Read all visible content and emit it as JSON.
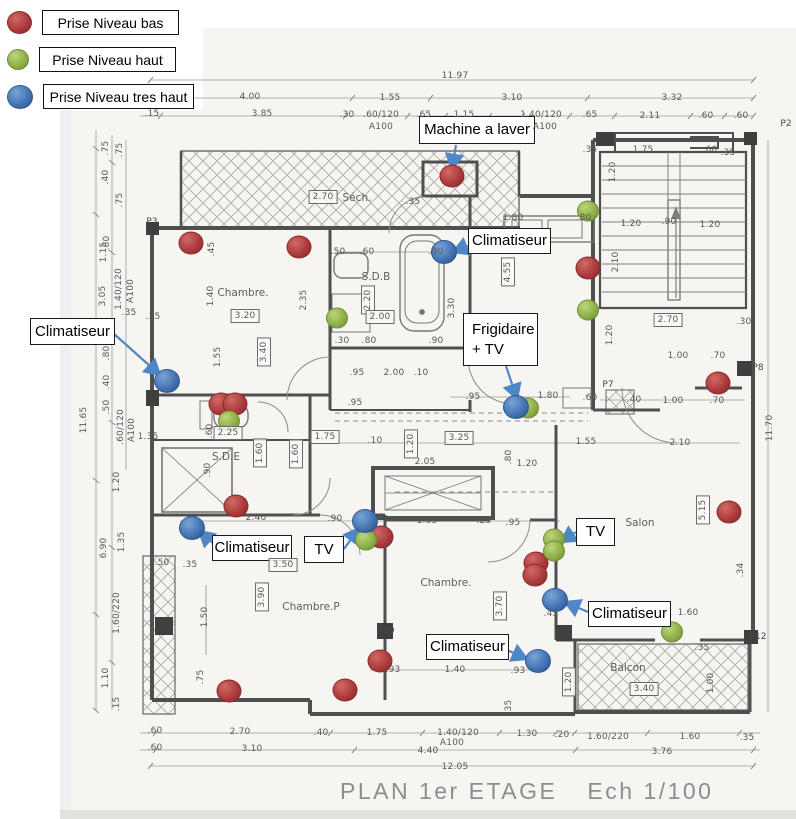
{
  "title": {
    "main": "PLAN 1er ETAGE",
    "scale": "Ech 1/100"
  },
  "colors": {
    "red": "#a93639",
    "green": "#8aac45",
    "blue": "#3e6fae",
    "arrow": "#4f86c6",
    "wall": "#4f4f4f"
  },
  "legend": {
    "items": [
      {
        "key": "low",
        "color": "red",
        "label": "Prise Niveau bas",
        "y": 10,
        "box_w": 137
      },
      {
        "key": "high",
        "color": "green",
        "label": "Prise Niveau haut",
        "y": 47,
        "box_w": 137
      },
      {
        "key": "very-high",
        "color": "blue",
        "label": "Prise Niveau tres haut",
        "y": 84,
        "box_w": 151
      }
    ]
  },
  "callouts": [
    {
      "id": "machine-a-laver",
      "lines": [
        "Machine a laver"
      ],
      "x": 419,
      "y": 116,
      "w": 116,
      "h": 28,
      "center": true,
      "arrow": {
        "from": [
          456,
          145
        ],
        "to": [
          452,
          169
        ]
      }
    },
    {
      "id": "climatiseur-top",
      "lines": [
        "Climatiseur"
      ],
      "x": 468,
      "y": 228,
      "w": 83,
      "h": 26,
      "center": true,
      "arrow": {
        "from": [
          468,
          246
        ],
        "to": [
          453,
          252
        ]
      }
    },
    {
      "id": "climatiseur-left",
      "lines": [
        "Climatiseur"
      ],
      "x": 30,
      "y": 318,
      "w": 85,
      "h": 27,
      "center": true,
      "arrow": {
        "from": [
          113,
          333
        ],
        "to": [
          160,
          375
        ]
      }
    },
    {
      "id": "frigidaire-tv",
      "lines": [
        "Frigidaire",
        "+ TV"
      ],
      "x": 463,
      "y": 313,
      "w": 75,
      "h": 53,
      "center": false,
      "arrow": {
        "from": [
          506,
          366
        ],
        "to": [
          517,
          399
        ]
      }
    },
    {
      "id": "climatiseur-midleft",
      "lines": [
        "Climatiseur"
      ],
      "x": 212,
      "y": 535,
      "w": 80,
      "h": 26,
      "center": true,
      "arrow": {
        "from": [
          220,
          549
        ],
        "to": [
          199,
          531
        ]
      }
    },
    {
      "id": "tv-mid",
      "lines": [
        "TV"
      ],
      "x": 304,
      "y": 536,
      "w": 40,
      "h": 27,
      "center": true,
      "arrow": {
        "from": [
          344,
          549
        ],
        "to": [
          359,
          528
        ]
      }
    },
    {
      "id": "tv-right",
      "lines": [
        "TV"
      ],
      "x": 576,
      "y": 518,
      "w": 39,
      "h": 28,
      "center": true,
      "arrow": {
        "from": [
          576,
          532
        ],
        "to": [
          561,
          542
        ]
      }
    },
    {
      "id": "climatiseur-right",
      "lines": [
        "Climatiseur"
      ],
      "x": 588,
      "y": 601,
      "w": 83,
      "h": 26,
      "center": true,
      "arrow": {
        "from": [
          588,
          612
        ],
        "to": [
          565,
          602
        ]
      }
    },
    {
      "id": "climatiseur-bottom",
      "lines": [
        "Climatiseur"
      ],
      "x": 426,
      "y": 634,
      "w": 83,
      "h": 26,
      "center": true,
      "arrow": {
        "from": [
          507,
          650
        ],
        "to": [
          527,
          659
        ]
      }
    }
  ],
  "outlets": {
    "red": [
      [
        191,
        243
      ],
      [
        299,
        247
      ],
      [
        452,
        176
      ],
      [
        588,
        268
      ],
      [
        718,
        383
      ],
      [
        221,
        404
      ],
      [
        235,
        404
      ],
      [
        236,
        506
      ],
      [
        381,
        537
      ],
      [
        536,
        563
      ],
      [
        535,
        575
      ],
      [
        729,
        512
      ],
      [
        380,
        661
      ],
      [
        229,
        691
      ],
      [
        345,
        690
      ]
    ],
    "green": [
      [
        588,
        211
      ],
      [
        588,
        310
      ],
      [
        337,
        318
      ],
      [
        229,
        421
      ],
      [
        528,
        408
      ],
      [
        366,
        540
      ],
      [
        554,
        539
      ],
      [
        554,
        551
      ],
      [
        672,
        632
      ]
    ],
    "blue": [
      [
        444,
        252
      ],
      [
        167,
        381
      ],
      [
        516,
        407
      ],
      [
        192,
        528
      ],
      [
        365,
        521
      ],
      [
        555,
        600
      ],
      [
        538,
        661
      ]
    ]
  },
  "rooms": [
    {
      "t": "Chambre.",
      "x": 243,
      "y": 293
    },
    {
      "t": "Séch.",
      "x": 357,
      "y": 198
    },
    {
      "t": "S.D.B",
      "x": 376,
      "y": 277
    },
    {
      "t": "S.D.E",
      "x": 226,
      "y": 457
    },
    {
      "t": "Chambre.",
      "x": 446,
      "y": 583
    },
    {
      "t": "Chambre.P",
      "x": 311,
      "y": 607
    },
    {
      "t": "Salon",
      "x": 640,
      "y": 523
    },
    {
      "t": "Balcon",
      "x": 628,
      "y": 668
    }
  ],
  "pillar_labels": [
    {
      "t": "P2",
      "x": 786,
      "y": 124
    },
    {
      "t": "P3",
      "x": 152,
      "y": 222
    },
    {
      "t": "P7",
      "x": 608,
      "y": 385
    },
    {
      "t": "P8",
      "x": 758,
      "y": 368
    },
    {
      "t": "P9",
      "x": 166,
      "y": 629
    },
    {
      "t": "P10",
      "x": 386,
      "y": 631
    },
    {
      "t": "P11",
      "x": 564,
      "y": 633
    },
    {
      "t": "P12",
      "x": 758,
      "y": 637
    }
  ],
  "dims": [
    [
      "11.97",
      455,
      76,
      ""
    ],
    [
      "4.00",
      250,
      97,
      ""
    ],
    [
      "1.55",
      390,
      98,
      ""
    ],
    [
      "3.10",
      512,
      98,
      ""
    ],
    [
      "3.32",
      672,
      98,
      ""
    ],
    [
      ".15",
      152,
      114,
      ""
    ],
    [
      "3.85",
      262,
      114,
      ""
    ],
    [
      ".30",
      347,
      115,
      ""
    ],
    [
      ".60/120",
      381,
      115,
      ""
    ],
    [
      ".65",
      424,
      115,
      ""
    ],
    [
      "1.15",
      464,
      115,
      ""
    ],
    [
      "1.40/120",
      541,
      115,
      ""
    ],
    [
      ".65",
      590,
      115,
      ""
    ],
    [
      "2.11",
      650,
      116,
      ""
    ],
    [
      ".60",
      706,
      116,
      ""
    ],
    [
      ".60",
      741,
      116,
      ""
    ],
    [
      "A100",
      381,
      127,
      ""
    ],
    [
      "A100",
      545,
      127,
      ""
    ],
    [
      "11.65",
      84,
      420,
      "v"
    ],
    [
      ".75",
      106,
      148,
      "v"
    ],
    [
      ".75",
      120,
      150,
      "v"
    ],
    [
      ".40",
      106,
      177,
      "v"
    ],
    [
      "1.15",
      104,
      252,
      "v"
    ],
    [
      ".75",
      120,
      200,
      "v"
    ],
    [
      ".80",
      107,
      243,
      "v"
    ],
    [
      "3.05",
      103,
      296,
      "v"
    ],
    [
      "1.40/120",
      119,
      289,
      "v"
    ],
    [
      "A100",
      131,
      291,
      "v"
    ],
    [
      ".35",
      129,
      313,
      ""
    ],
    [
      ".80",
      107,
      353,
      "v"
    ],
    [
      ".40",
      107,
      382,
      "v"
    ],
    [
      ".50",
      107,
      407,
      "v"
    ],
    [
      ".60/120",
      121,
      427,
      "v"
    ],
    [
      "A100",
      132,
      430,
      "v"
    ],
    [
      "1.20",
      117,
      482,
      "v"
    ],
    [
      "1.35",
      122,
      542,
      "v"
    ],
    [
      "6.90",
      104,
      548,
      "v"
    ],
    [
      "1.60/220",
      117,
      613,
      "v"
    ],
    [
      "1.10",
      106,
      678,
      "v"
    ],
    [
      ".15",
      117,
      704,
      "v"
    ],
    [
      "11.70",
      770,
      428,
      "v"
    ],
    [
      ".30",
      744,
      322,
      ""
    ],
    [
      ".70",
      718,
      356,
      ""
    ],
    [
      ".70",
      717,
      401,
      ""
    ],
    [
      "1.00",
      678,
      356,
      ""
    ],
    [
      "1.00",
      673,
      401,
      ""
    ],
    [
      ".60",
      590,
      398,
      ""
    ],
    [
      ".40",
      634,
      400,
      ""
    ],
    [
      "1.55",
      586,
      442,
      ""
    ],
    [
      "2.10",
      680,
      443,
      ""
    ],
    [
      "5.15",
      703,
      510,
      "vb"
    ],
    [
      ".34",
      741,
      570,
      "v"
    ],
    [
      "1.75",
      643,
      150,
      ""
    ],
    [
      ".60",
      710,
      150,
      ""
    ],
    [
      ".35",
      728,
      153,
      ""
    ],
    [
      ".35",
      590,
      150,
      ""
    ],
    [
      "1.20",
      613,
      172,
      "v"
    ],
    [
      "1.20",
      631,
      224,
      ""
    ],
    [
      ".90",
      669,
      222,
      ""
    ],
    [
      "1.20",
      710,
      225,
      ""
    ],
    [
      "2.10",
      616,
      262,
      "v"
    ],
    [
      "2.70",
      668,
      320,
      "b"
    ],
    [
      "2.70",
      323,
      197,
      "b"
    ],
    [
      ".35",
      413,
      202,
      ""
    ],
    [
      "1.80",
      513,
      218,
      ""
    ],
    [
      ".80",
      584,
      218,
      ""
    ],
    [
      "4.55",
      508,
      272,
      "vb"
    ],
    [
      ".35",
      153,
      317,
      ""
    ],
    [
      ".50",
      338,
      252,
      ""
    ],
    [
      ".60",
      367,
      252,
      ""
    ],
    [
      ".90",
      436,
      252,
      ""
    ],
    [
      "2.20",
      368,
      300,
      "vb"
    ],
    [
      "2.00",
      380,
      317,
      "b"
    ],
    [
      ".30",
      342,
      341,
      ""
    ],
    [
      ".80",
      369,
      341,
      ""
    ],
    [
      ".90",
      436,
      341,
      ""
    ],
    [
      "3.30",
      452,
      308,
      "v"
    ],
    [
      ".95",
      357,
      373,
      ""
    ],
    [
      "2.00",
      394,
      373,
      ""
    ],
    [
      ".10",
      421,
      373,
      ""
    ],
    [
      ".45",
      212,
      249,
      "v"
    ],
    [
      "1.40",
      211,
      296,
      "v"
    ],
    [
      "2.35",
      304,
      300,
      "v"
    ],
    [
      "3.20",
      245,
      316,
      "b"
    ],
    [
      "3.40",
      264,
      352,
      "vb"
    ],
    [
      "1.55",
      218,
      357,
      "v"
    ],
    [
      "1.35",
      148,
      437,
      ""
    ],
    [
      "2.25",
      228,
      433,
      "b"
    ],
    [
      "1.60",
      260,
      453,
      "vb"
    ],
    [
      "1.60",
      296,
      454,
      "vb"
    ],
    [
      "1.75",
      325,
      437,
      "b"
    ],
    [
      ".60",
      210,
      431,
      "v"
    ],
    [
      ".90",
      208,
      470,
      "v"
    ],
    [
      ".95",
      355,
      403,
      ""
    ],
    [
      ".10",
      375,
      441,
      ""
    ],
    [
      "3.25",
      459,
      438,
      "b"
    ],
    [
      "2.05",
      425,
      462,
      ""
    ],
    [
      "1.20",
      411,
      444,
      "vb"
    ],
    [
      "1.20",
      527,
      464,
      ""
    ],
    [
      ".80",
      509,
      457,
      "v"
    ],
    [
      "1.85",
      427,
      521,
      ""
    ],
    [
      ".25",
      484,
      521,
      ""
    ],
    [
      ".95",
      513,
      523,
      ""
    ],
    [
      ".90",
      335,
      519,
      ""
    ],
    [
      "2.40",
      256,
      518,
      ""
    ],
    [
      ".95",
      473,
      397,
      ""
    ],
    [
      "1.80",
      548,
      396,
      ""
    ],
    [
      "1.20",
      610,
      335,
      "v"
    ],
    [
      "3.50",
      283,
      565,
      "b"
    ],
    [
      "3.90",
      262,
      597,
      "vb"
    ],
    [
      "1.50",
      205,
      617,
      "v"
    ],
    [
      ".75",
      201,
      677,
      "v"
    ],
    [
      ".35",
      190,
      565,
      ""
    ],
    [
      ".50",
      162,
      563,
      ""
    ],
    [
      "3.70",
      500,
      606,
      "vb"
    ],
    [
      ".45",
      551,
      614,
      ""
    ],
    [
      "1.60",
      688,
      613,
      ""
    ],
    [
      ".93",
      393,
      670,
      ""
    ],
    [
      "1.40",
      455,
      670,
      ""
    ],
    [
      ".93",
      518,
      671,
      ""
    ],
    [
      ".35",
      509,
      707,
      "v"
    ],
    [
      "1.20",
      569,
      682,
      "vb"
    ],
    [
      "1.00",
      711,
      683,
      "v"
    ],
    [
      ".35",
      702,
      648,
      ""
    ],
    [
      "3.40",
      644,
      689,
      "b"
    ],
    [
      ".60",
      155,
      731,
      ""
    ],
    [
      "2.70",
      240,
      732,
      ""
    ],
    [
      ".40",
      321,
      733,
      ""
    ],
    [
      "1.75",
      377,
      733,
      ""
    ],
    [
      "1.40/120",
      458,
      733,
      ""
    ],
    [
      "A100",
      452,
      743,
      ""
    ],
    [
      "1.30",
      527,
      734,
      ""
    ],
    [
      ".20",
      562,
      735,
      ""
    ],
    [
      "1.60/220",
      608,
      737,
      ""
    ],
    [
      "1.60",
      690,
      737,
      ""
    ],
    [
      ".35",
      747,
      738,
      ""
    ],
    [
      ".60",
      155,
      748,
      ""
    ],
    [
      "3.10",
      252,
      749,
      ""
    ],
    [
      "4.40",
      428,
      751,
      ""
    ],
    [
      "3.76",
      662,
      752,
      ""
    ],
    [
      "12.05",
      455,
      767,
      ""
    ]
  ]
}
